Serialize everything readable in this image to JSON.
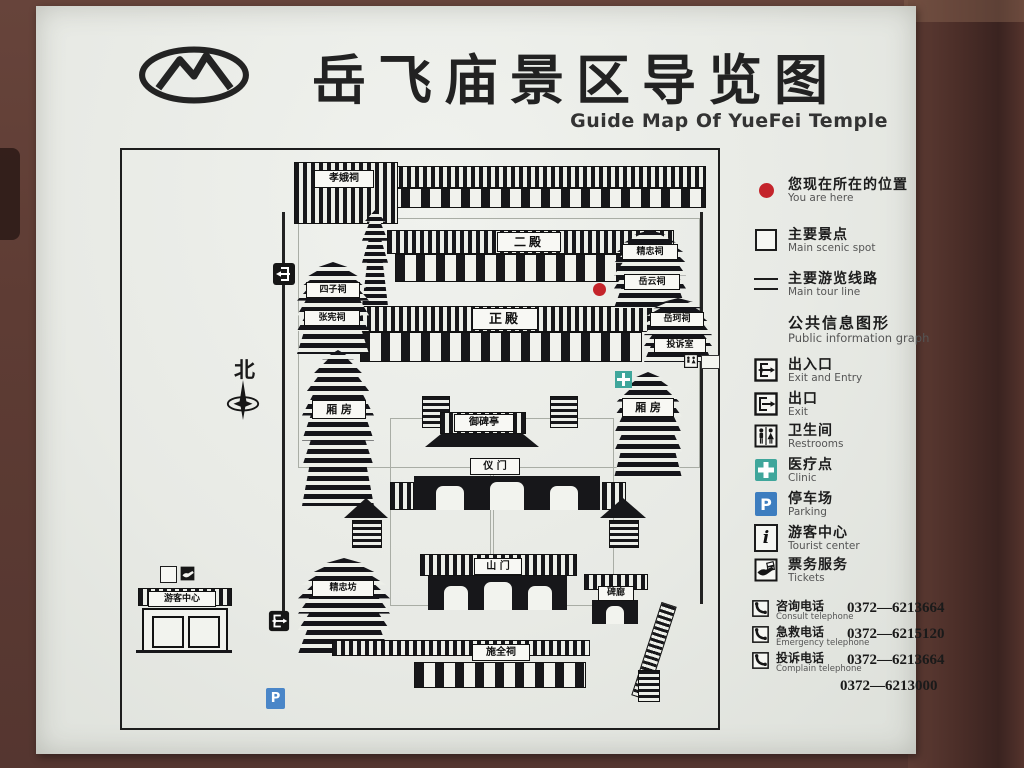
{
  "title": {
    "cn": "岳飞庙景区导览图",
    "en": "Guide Map Of YueFei Temple"
  },
  "legend": {
    "items": [
      {
        "icon": "red-dot",
        "cn": "您现在所在的位置",
        "en": "You are here"
      },
      {
        "icon": "white-square",
        "cn": "主要景点",
        "en": "Main scenic spot"
      },
      {
        "icon": "double-line",
        "cn": "主要游览线路",
        "en": "Main tour line"
      }
    ],
    "info_header": {
      "cn": "公共信息图形",
      "en": "Public information graph"
    },
    "info_items": [
      {
        "icon": "exit-entry-icon",
        "cn": "出入口",
        "en": "Exit and Entry"
      },
      {
        "icon": "exit-icon",
        "cn": "出口",
        "en": "Exit"
      },
      {
        "icon": "restrooms-icon",
        "cn": "卫生间",
        "en": "Restrooms"
      },
      {
        "icon": "clinic-cross-icon",
        "cn": "医疗点",
        "en": "Clinic"
      },
      {
        "icon": "parking-icon",
        "cn": "停车场",
        "en": "Parking"
      },
      {
        "icon": "info-icon",
        "cn": "游客中心",
        "en": "Tourist center"
      },
      {
        "icon": "tickets-icon",
        "cn": "票务服务",
        "en": "Tickets"
      }
    ],
    "phones": [
      {
        "cn": "咨询电话",
        "en": "Consult telephone",
        "number": "0372—6213664"
      },
      {
        "cn": "急救电话",
        "en": "Emergency telephone",
        "number": "0372—6215120"
      },
      {
        "cn": "投诉电话",
        "en": "Complain telephone",
        "number": "0372—6213664"
      },
      {
        "cn": "",
        "en": "",
        "number": "0372—6213000"
      }
    ]
  },
  "map": {
    "labels": {
      "xiaoeci": "孝娥祠",
      "erdian": "二殿",
      "zhengdian": "正殿",
      "jingzhongci": "精忠祠",
      "yueyunci": "岳云祠",
      "yuekeci": "岳珂祠",
      "tousushi": "投诉室",
      "sizici": "四子祠",
      "zhangxianci": "张宪祠",
      "xiangfang": "厢 房",
      "yubeiting": "御碑亭",
      "yimen": "仪 门",
      "shanmen": "山 门",
      "jingzhongfang": "精忠坊",
      "shiquanci": "施全祠",
      "youke": "游客中心",
      "beilang": "碑廊",
      "north": "北"
    },
    "glyphs": {
      "parking_letter": "P",
      "info_letter": "i"
    }
  },
  "colors": {
    "frame_brown": "#5e3c34",
    "panel": "#e8eae5",
    "ink": "#17171a",
    "you_are_here_red": "#c4242b",
    "clinic_teal": "#3fa69b",
    "parking_blue": "#3d7dbf"
  }
}
